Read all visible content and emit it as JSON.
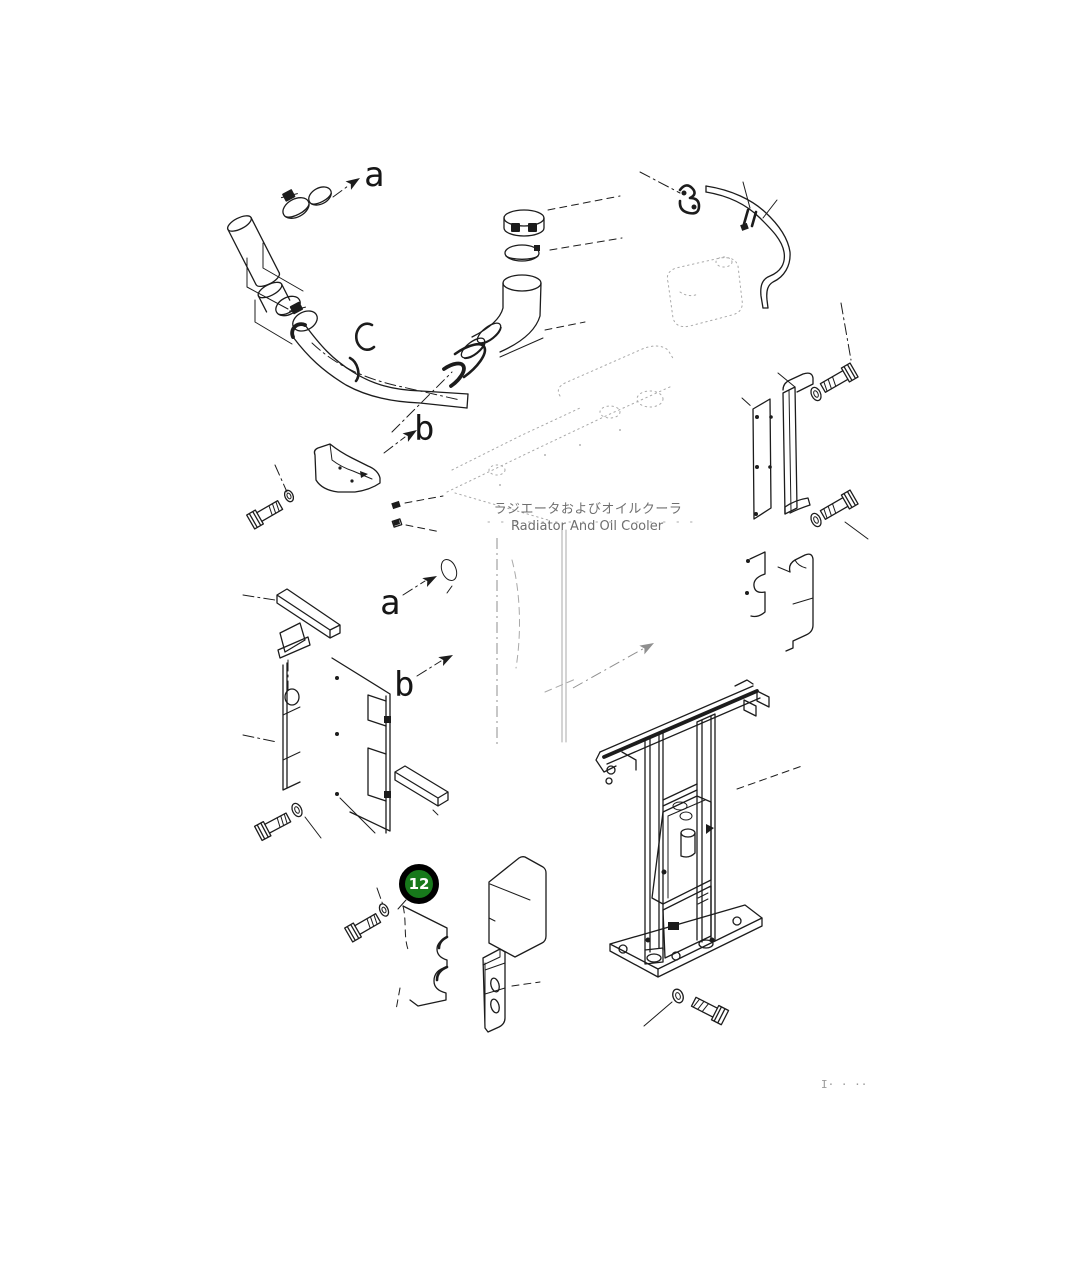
{
  "page": {
    "background": "#ffffff"
  },
  "diagram": {
    "title_jp": "ラジエータおよびオイルクーラ",
    "title_en": "Radiator And Oil Cooler",
    "direction_labels": [
      {
        "id": "a-top-left",
        "text": "a"
      },
      {
        "id": "b-upper-middle",
        "text": "b"
      },
      {
        "id": "a-middle-left",
        "text": "a"
      },
      {
        "id": "b-middle-left",
        "text": "b"
      }
    ],
    "callouts": [
      {
        "number": "12",
        "fill": "#17791b",
        "ring": "#000000",
        "text_color": "#ffffff"
      }
    ],
    "footer_mark": "I· ·  ··",
    "line_color": "#1c1c1c",
    "faint_color": "#a9a9a9"
  }
}
